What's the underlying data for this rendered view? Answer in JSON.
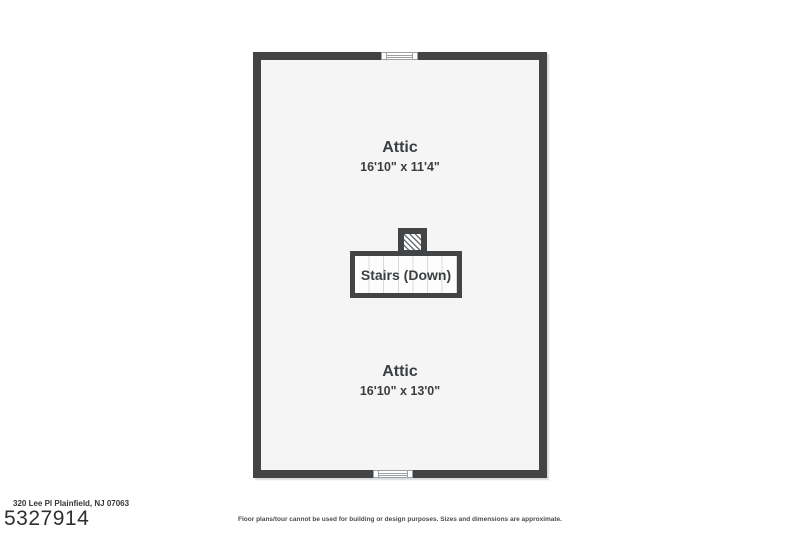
{
  "floorplan": {
    "level_type": "attic-floor-plan",
    "rooms": [
      {
        "name": "Attic",
        "dimensions": "16'10\" x 11'4\""
      },
      {
        "name": "Attic",
        "dimensions": "16'10\" x 13'0\""
      }
    ],
    "stairs_label": "Stairs (Down)",
    "features": [
      "window-top-wall",
      "window-bottom-wall",
      "hatched-stair-opening"
    ]
  },
  "footer": {
    "address": "320 Lee Pl Plainfield, NJ 07063",
    "mls_number": "5327914",
    "disclaimer": "Floor plans/tour cannot be used for building or design purposes. Sizes and dimensions are approximate."
  },
  "colors": {
    "wall": "#424446",
    "floor": "#f5f5f6",
    "stairs_fill": "#fdfdfd",
    "tread_line": "#d9dadb",
    "label_text": "#3b3e40",
    "page_background": "#ffffff"
  }
}
